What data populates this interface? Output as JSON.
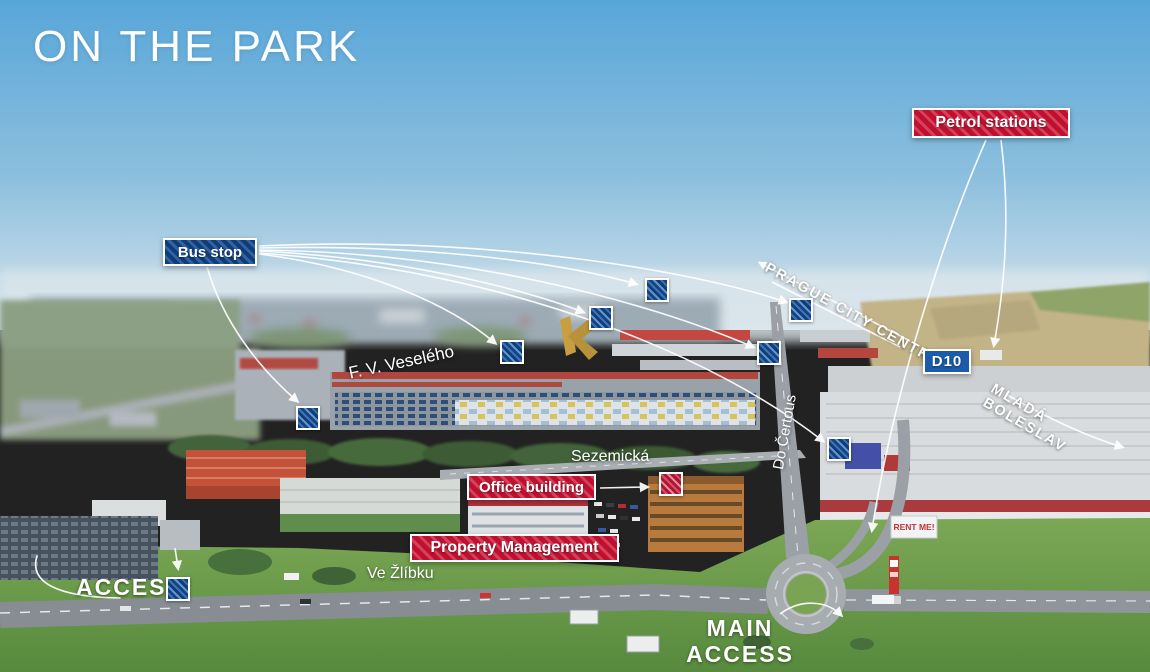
{
  "title": "ON THE PARK",
  "map_labels": {
    "petrol_stations": "Petrol stations",
    "bus_stop": "Bus stop",
    "d10": "D10",
    "prague_city_centre": "PRAGUE CITY CENTRE",
    "mlada_boleslav": "MLADÁ BOLESLAV",
    "office_building": "Office building",
    "property_management": "Property Management",
    "access": "ACCESS",
    "main_access_line1": "MAIN",
    "main_access_line2": "ACCESS"
  },
  "street_names": {
    "fv_veseleho": "F. V. Veselého",
    "sezemicka": "Sezemická",
    "ve_zlibku": "Ve Žlíbku",
    "do_certous": "Do Čertous"
  },
  "billboard": {
    "rent_me": "RENT ME!"
  },
  "colors": {
    "label_red": "#c51434",
    "label_blue": "#16437e",
    "road_sign_blue": "#1a5cab",
    "overlay_white": "#ffffff"
  }
}
